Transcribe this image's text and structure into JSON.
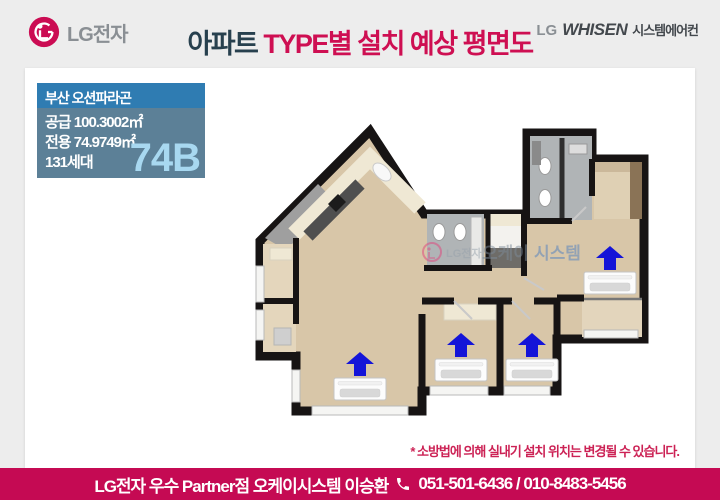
{
  "header": {
    "lg_logo_text": "LG전자",
    "title": {
      "prefix": "아파트 ",
      "rest": "TYPE별 설치 예상 평면도"
    },
    "whisen": {
      "lg": "LG",
      "brand": "WHISEN",
      "suffix": "시스템에어컨"
    }
  },
  "info_box": {
    "title": "부산 오션파라곤",
    "lines": [
      "공급 100.3002㎡",
      "전용 74.9749㎡",
      "131세대"
    ],
    "type_code": "74B"
  },
  "floor_plan": {
    "watermark": {
      "lg": "LG전자",
      "part1": "오케이",
      "part2": "시스템"
    },
    "indoor_unit_count": "4"
  },
  "note": "* 소방법에 의해 실내기 설치 위치는 변경될 수 있습니다.",
  "footer": {
    "dealer": "LG전자 우수 Partner점 오케이시스템  이승환",
    "phones": "051-501-6436 / 010-8483-5456"
  },
  "colors": {
    "accent": "#c50a53",
    "title_navy": "#27404e",
    "title_red": "#ce0f52",
    "arrow_blue": "#1414d8",
    "info_header_bg": "#2f7cb2",
    "info_body_bg": "#5c8097",
    "type_code_color": "#a8d8f0"
  }
}
